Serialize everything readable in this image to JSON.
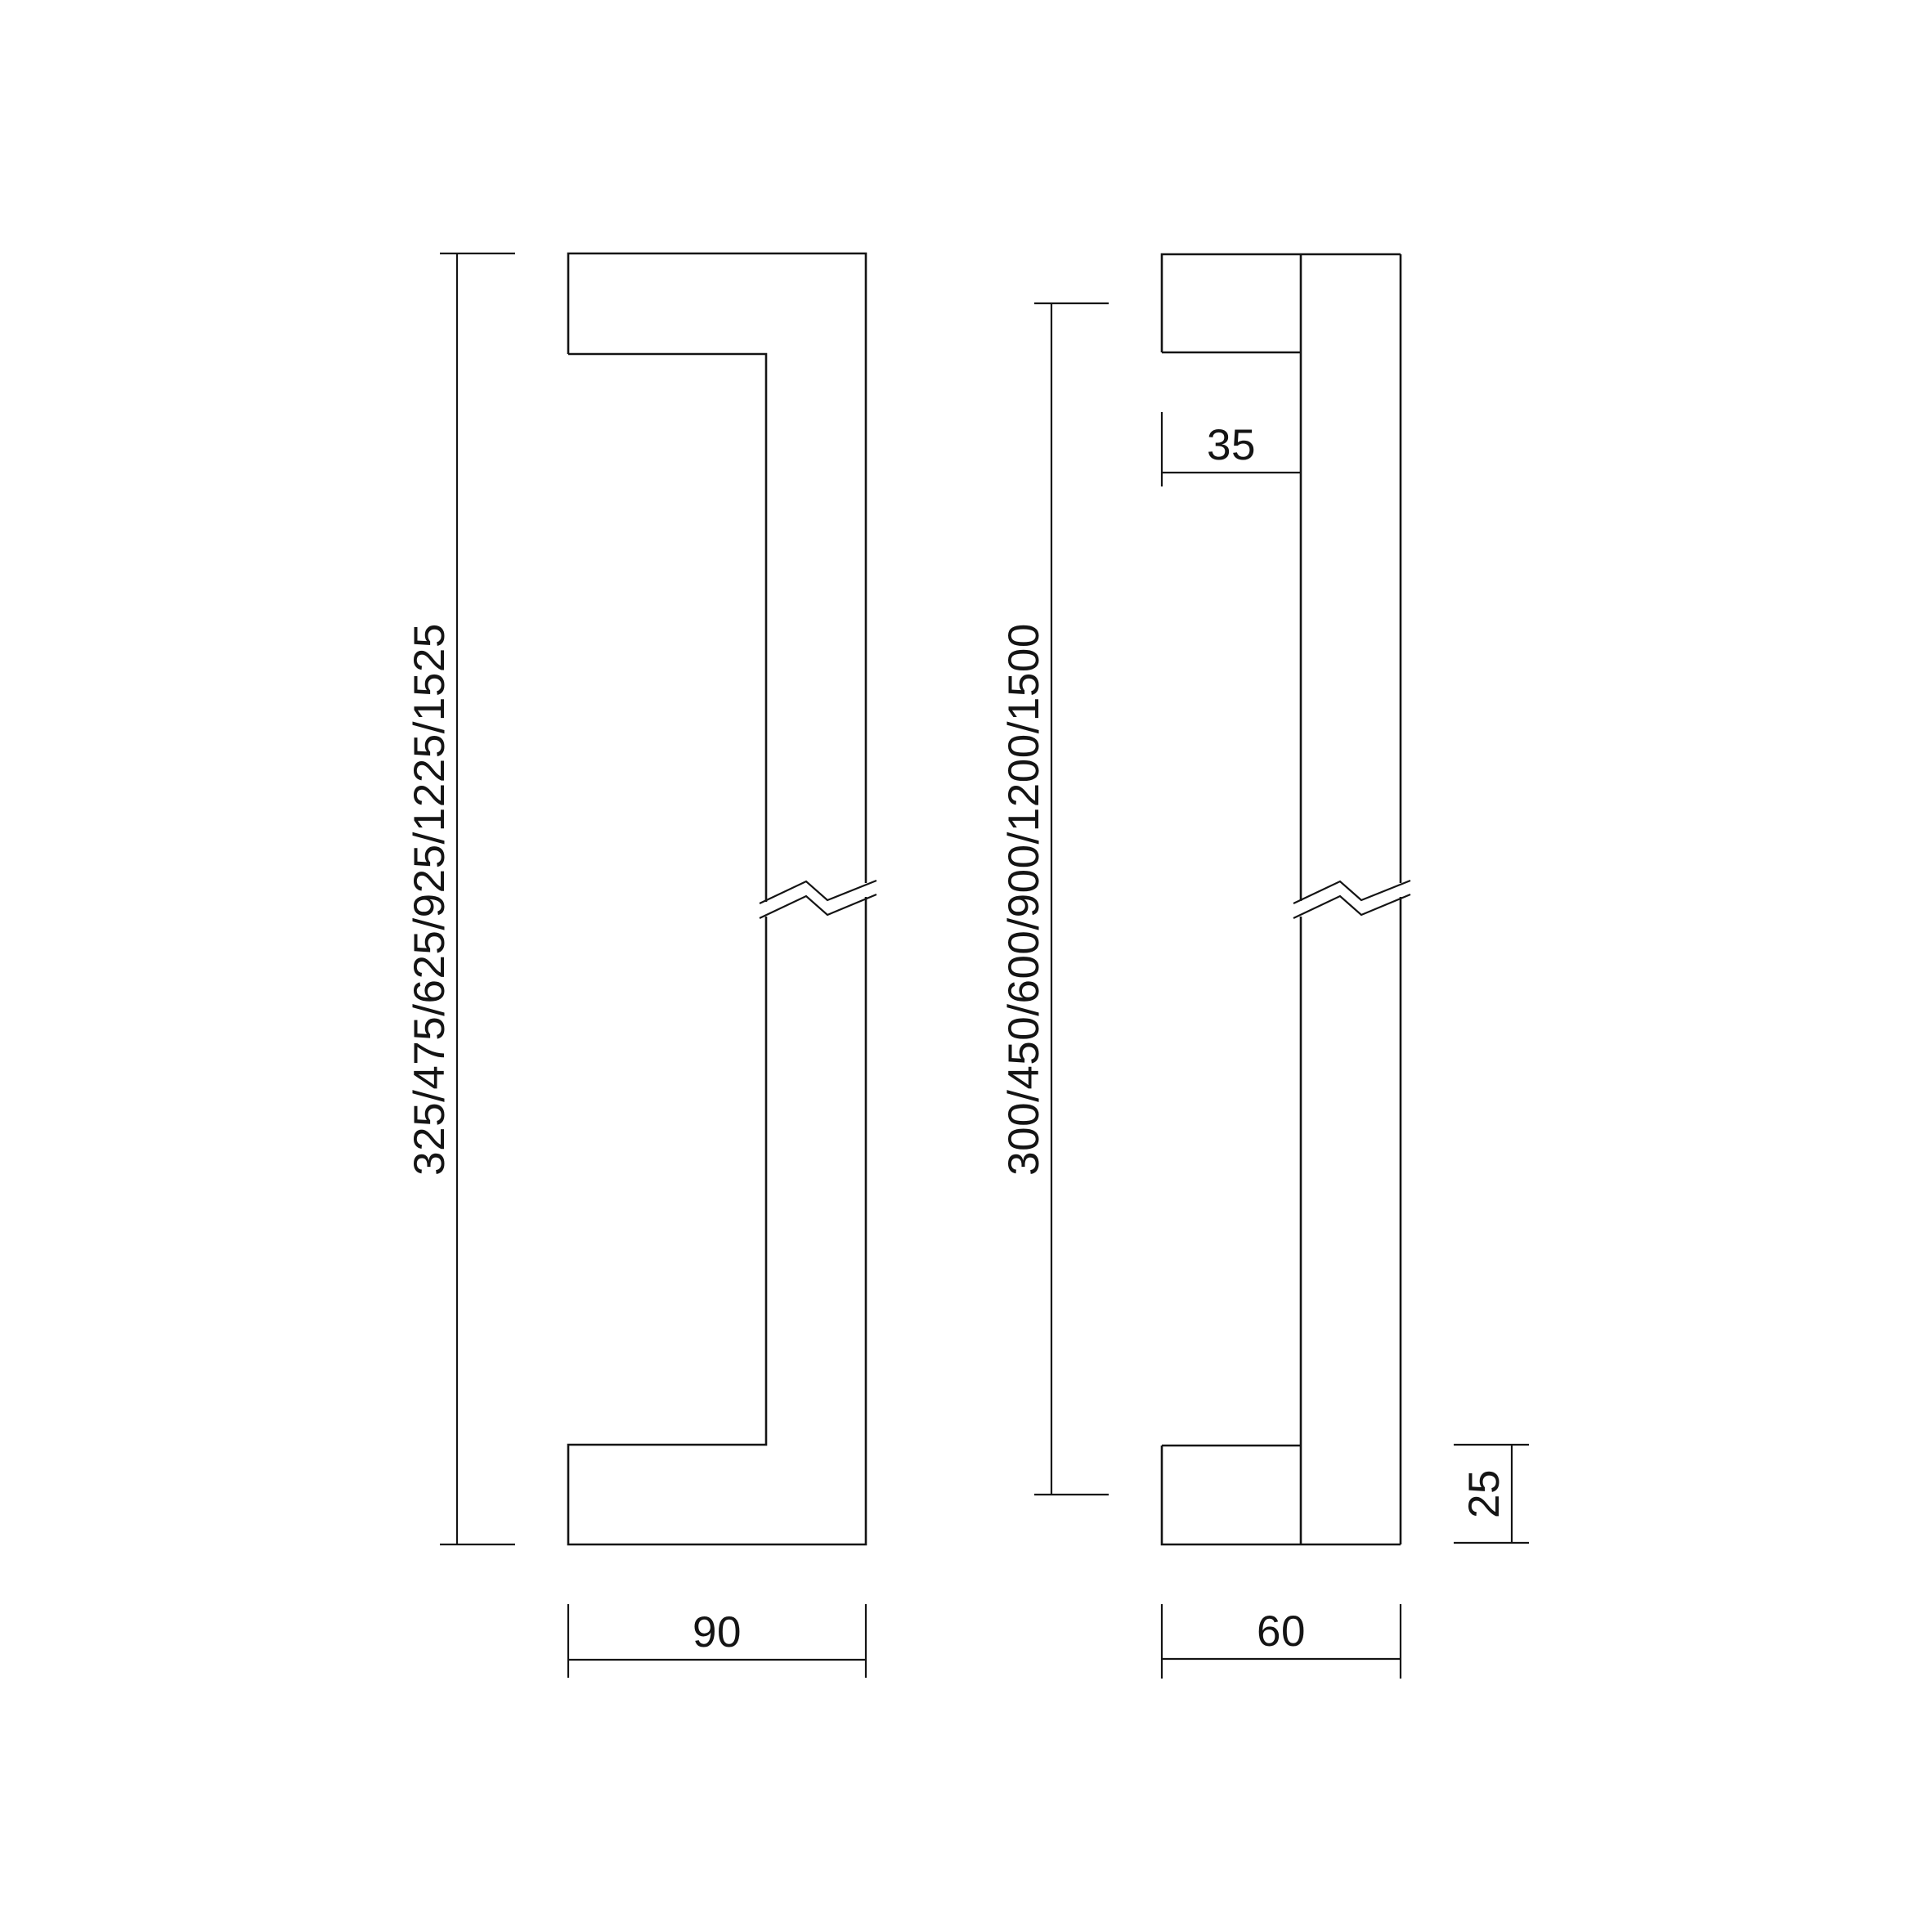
{
  "drawing": {
    "background": "#ffffff",
    "line_color": "#141414",
    "side_view": {
      "overall_length_options": "325/475/625/925/1225/1525",
      "overall_depth": "90"
    },
    "front_view": {
      "centre_distance_options": "300/450/600/900/1200/1500",
      "standoff_depth": "35",
      "foot_height": "25",
      "overall_width": "60"
    }
  }
}
